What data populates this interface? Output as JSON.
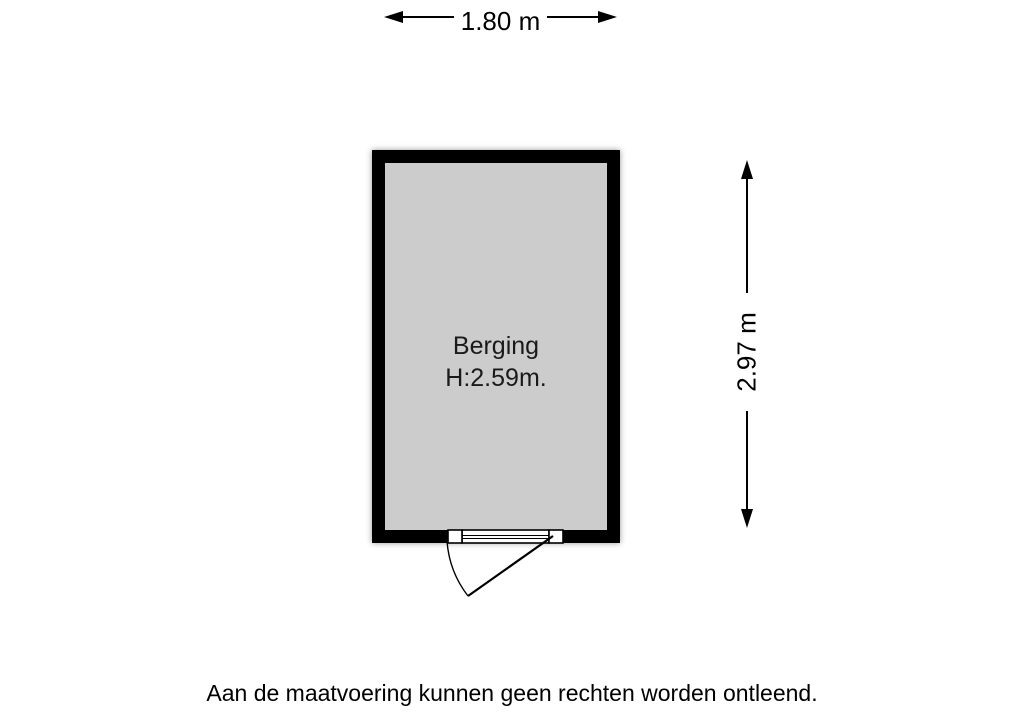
{
  "floorplan": {
    "room": {
      "name": "Berging",
      "ceiling_height": "H:2.59m."
    },
    "dimensions": {
      "width": "1.80 m",
      "height": "2.97 m"
    },
    "disclaimer": "Aan de maatvoering kunnen geen rechten worden ontleend.",
    "colors": {
      "wall": "#000000",
      "floor": "#cccccc",
      "line": "#000000",
      "background": "#ffffff"
    }
  }
}
